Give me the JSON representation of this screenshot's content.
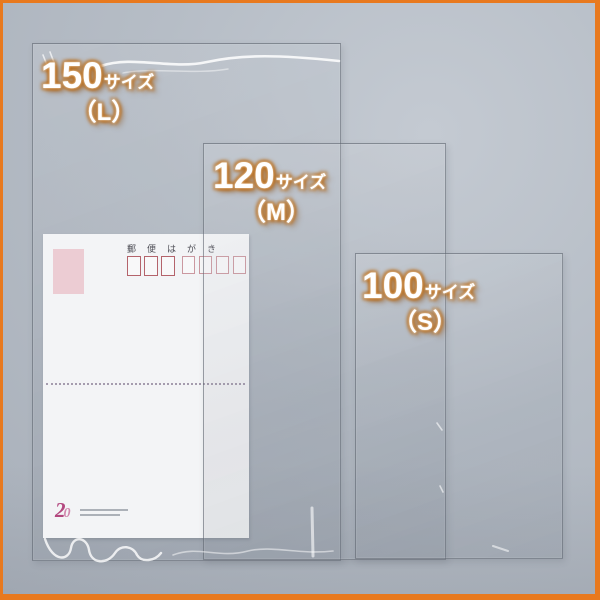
{
  "frame": {
    "border_color": "#e8791e",
    "background_color": "#b5bcc5"
  },
  "size_labels": [
    {
      "number": "150",
      "suffix": "サイズ",
      "letter": "（L）"
    },
    {
      "number": "120",
      "suffix": "サイズ",
      "letter": "（M）"
    },
    {
      "number": "100",
      "suffix": "サイズ",
      "letter": "（S）"
    }
  ],
  "postcard": {
    "title": "郵便はがき",
    "postal_box_count": 7,
    "logo_digit_1": "2",
    "logo_digit_2": "0"
  },
  "colors": {
    "label_text": "#ffffff",
    "label_glow": "#ba6e1c",
    "bag_edge": "#606772",
    "postcard_bg": "#f3f4f6",
    "stamp_pink": "#ecccd3",
    "postal_box_red": "#b4636b",
    "postal_box_red_light": "#cb98a0",
    "fold_line": "#8b7f96",
    "logo_magenta": "#b3487f",
    "logo_pink": "#d187ae"
  }
}
